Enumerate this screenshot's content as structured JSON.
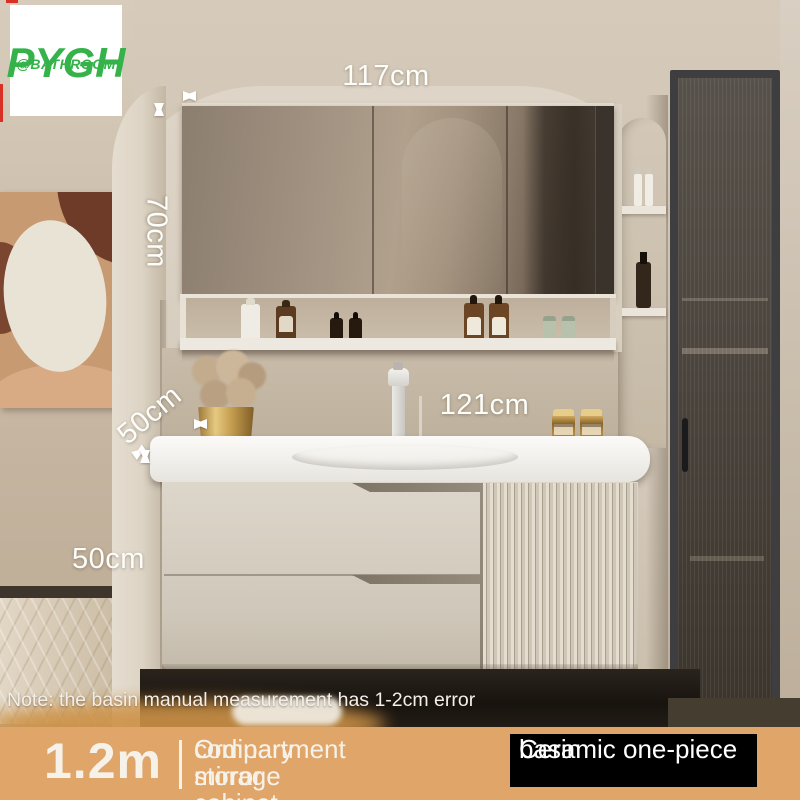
{
  "logo": {
    "brand": "PYGH",
    "handle": "@BATHROOM"
  },
  "dims": {
    "mirror_width": "117cm",
    "mirror_height": "70cm",
    "counter_depth": "50cm",
    "counter_width": "121cm",
    "cabinet_height": "50cm"
  },
  "note": {
    "text": "Note: the basin manual measurement has 1-2cm error"
  },
  "footer": {
    "size": "1.2m",
    "feature_line1": "Ordinary storage",
    "feature_line2": "compartment mirror cabinet",
    "badge_line1": "Ceramic one-piece",
    "badge_line2": "basin"
  },
  "colors": {
    "brand_green": "#35b34a",
    "footer_bar": "#dfa569",
    "badge_bg": "#000000",
    "annotation": "#ffffff",
    "crop_mark_red": "#d93025",
    "cabinet_cream": "#d5cdc0",
    "countertop_white": "#f3f1ed"
  }
}
